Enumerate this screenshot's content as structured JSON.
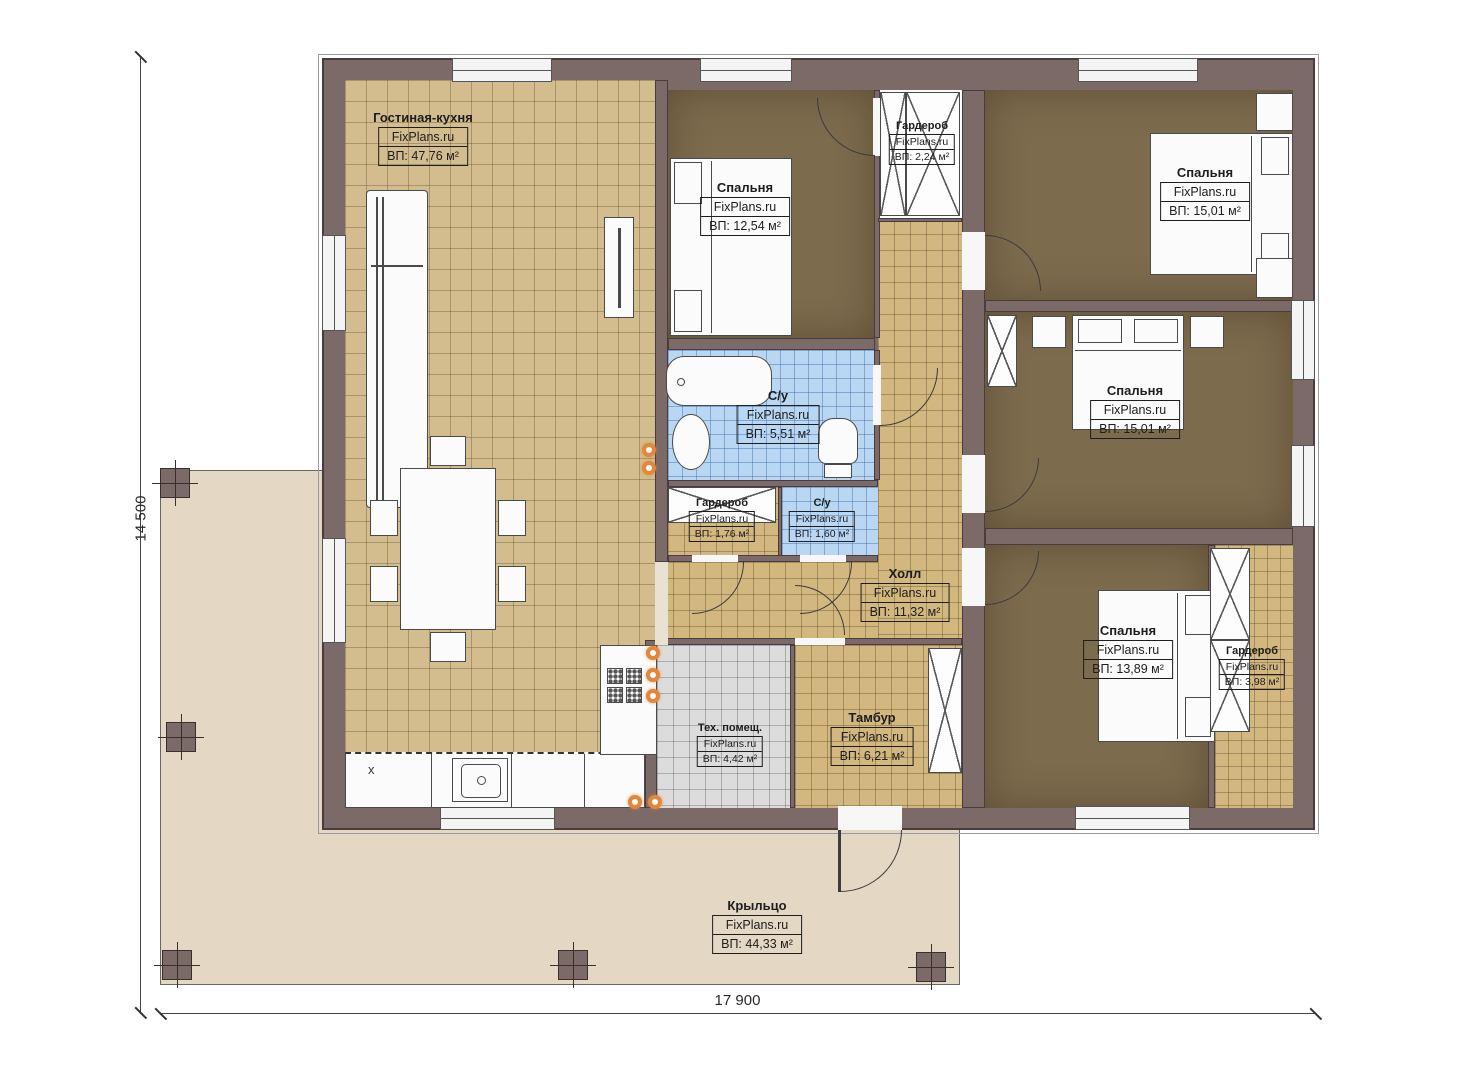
{
  "plan": {
    "brand": "FixPlans.ru",
    "dims": {
      "height_label": "14 500",
      "width_label": "17 900"
    },
    "kitchen_marker": "x",
    "colors": {
      "wall": "#7c6a68",
      "floor_tan": "#d3bd8f",
      "floor_dark": "#7d6b4e",
      "floor_blue": "#b9d6f2",
      "floor_hall": "#d2b77f",
      "floor_gray": "#dcdcdc",
      "porch": "#e4d7c4",
      "downlight": "#e2873b"
    },
    "rooms": {
      "living": {
        "name": "Гостиная-кухня",
        "area": "ВП: 47,76 м²"
      },
      "bedroom_top": {
        "name": "Спальня",
        "area": "ВП: 12,54 м²"
      },
      "wardrobe_top": {
        "name": "Гардероб",
        "area": "ВП: 2,24 м²"
      },
      "bedroom_right1": {
        "name": "Спальня",
        "area": "ВП: 15,01 м²"
      },
      "bedroom_right2": {
        "name": "Спальня",
        "area": "ВП: 15,01 м²"
      },
      "bath_main": {
        "name": "С/у",
        "area": "ВП: 5,51 м²"
      },
      "wardrobe_mid": {
        "name": "Гардероб",
        "area": "ВП: 1,76 м²"
      },
      "bath_small": {
        "name": "С/у",
        "area": "ВП: 1,60 м²"
      },
      "hall": {
        "name": "Холл",
        "area": "ВП: 11,32 м²"
      },
      "bedroom_bottom": {
        "name": "Спальня",
        "area": "ВП: 13,89 м²"
      },
      "wardrobe_bottom": {
        "name": "Гардероб",
        "area": "ВП: 3,98 м²"
      },
      "tech": {
        "name": "Тех. помещ.",
        "area": "ВП: 4,42 м²"
      },
      "tambur": {
        "name": "Тамбур",
        "area": "ВП: 6,21 м²"
      },
      "porch": {
        "name": "Крыльцо",
        "area": "ВП: 44,33 м²"
      }
    }
  }
}
